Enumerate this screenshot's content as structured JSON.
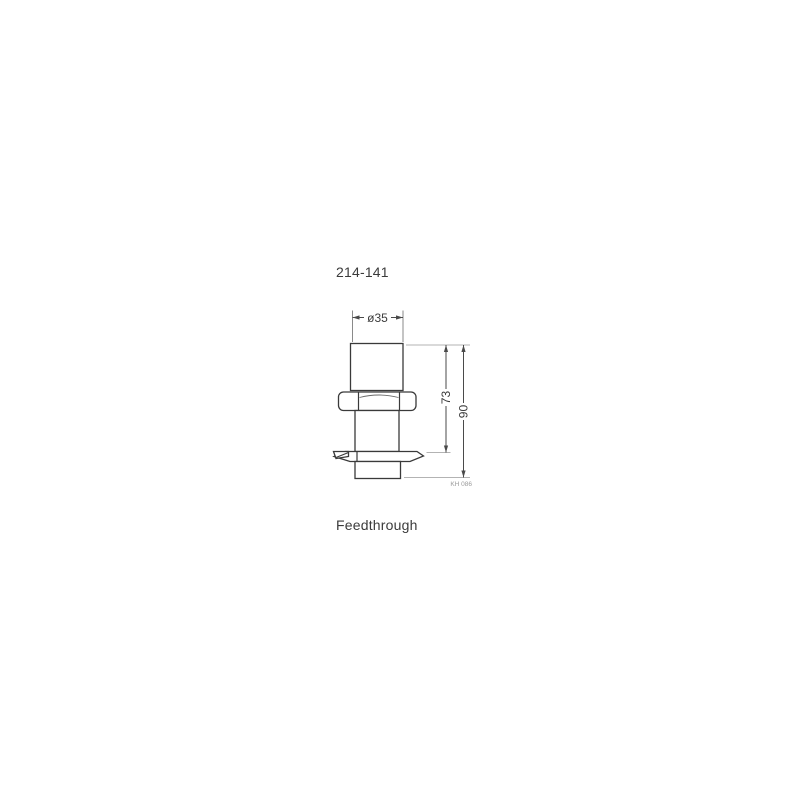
{
  "page": {
    "background_color": "#ffffff"
  },
  "drawing": {
    "part_number": "214-141",
    "caption": "Feedthrough",
    "reference_code": "KH 086",
    "dimensions": {
      "diameter": "ø35",
      "height_to_flange": "73",
      "overall_height": "90"
    },
    "colors": {
      "outline": "#3a3a3a",
      "dimension_line": "#4a4a4a",
      "extension_line": "#b3b3b3",
      "label_text": "#3b3b3b",
      "reference_text": "#9a9a9a"
    }
  }
}
